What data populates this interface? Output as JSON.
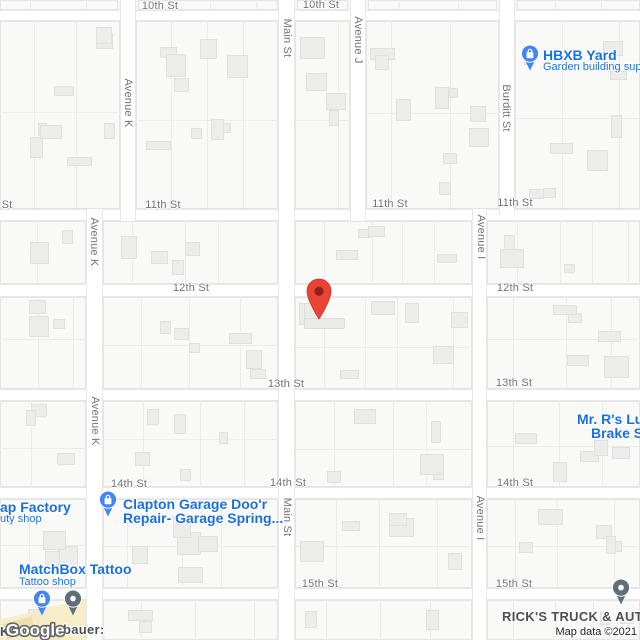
{
  "map_meta": {
    "logo": "Google",
    "attribution": "Map data ©2021"
  },
  "colors": {
    "poi_blue_text": "#1a6fdf",
    "poi_pin_blue": "#4285f4",
    "poi_pin_gray": "#5d7078",
    "poi_dark_text": "#4b4f54",
    "street_label": "#6f747a",
    "marker_red": "#EA4335",
    "marker_inner": "#8A231A",
    "road_fill": "#ffffff",
    "land": "#f6f6f4"
  },
  "street_labels": [
    {
      "t": "10th St",
      "x": 160,
      "y": 6
    },
    {
      "t": "10th St",
      "x": 321,
      "y": 5
    },
    {
      "t": "St",
      "x": 7,
      "y": 205
    },
    {
      "t": "11th St",
      "x": 163,
      "y": 205
    },
    {
      "t": "11th St",
      "x": 390,
      "y": 204
    },
    {
      "t": "11th St",
      "x": 515,
      "y": 203
    },
    {
      "t": "12th St",
      "x": 191,
      "y": 288
    },
    {
      "t": "12th St",
      "x": 515,
      "y": 288
    },
    {
      "t": "13th St",
      "x": 286,
      "y": 384
    },
    {
      "t": "13th St",
      "x": 514,
      "y": 383
    },
    {
      "t": "14th St",
      "x": 129,
      "y": 484
    },
    {
      "t": "14th St",
      "x": 288,
      "y": 483
    },
    {
      "t": "14th St",
      "x": 515,
      "y": 483
    },
    {
      "t": "15th St",
      "x": 320,
      "y": 584
    },
    {
      "t": "15th St",
      "x": 514,
      "y": 584
    },
    {
      "t": "Avenue K",
      "x": 128,
      "y": 103,
      "r": 1
    },
    {
      "t": "Avenue K",
      "x": 94,
      "y": 242,
      "r": 1
    },
    {
      "t": "Avenue K",
      "x": 95,
      "y": 421,
      "r": 1
    },
    {
      "t": "Main St",
      "x": 287,
      "y": 38,
      "r": 1
    },
    {
      "t": "Main St",
      "x": 287,
      "y": 517,
      "r": 1
    },
    {
      "t": "Avenue J",
      "x": 358,
      "y": 40,
      "r": 1
    },
    {
      "t": "Burditt St",
      "x": 506,
      "y": 108,
      "r": 1
    },
    {
      "t": "Avenue I",
      "x": 481,
      "y": 237,
      "r": 1
    },
    {
      "t": "Avenue I",
      "x": 480,
      "y": 518,
      "r": 1
    }
  ],
  "roads": {
    "h": [
      {
        "n": "10th-st",
        "y": 10,
        "h": 11,
        "x1": 0,
        "x2": 640
      },
      {
        "n": "11th-st",
        "y": 209,
        "h": 12,
        "x1": 0,
        "x2": 640
      },
      {
        "n": "12th-st",
        "y": 284,
        "h": 13,
        "x1": 0,
        "x2": 640
      },
      {
        "n": "13th-st",
        "y": 389,
        "h": 12,
        "x1": 0,
        "x2": 640
      },
      {
        "n": "14th-st",
        "y": 487,
        "h": 12,
        "x1": 0,
        "x2": 640
      },
      {
        "n": "15th-st",
        "y": 588,
        "h": 12,
        "x1": 0,
        "x2": 640
      }
    ],
    "v": [
      {
        "n": "avenue-k-upper",
        "x": 120,
        "w": 16,
        "y1": 0,
        "y2": 221
      },
      {
        "n": "avenue-k-lower",
        "x": 86,
        "w": 17,
        "y1": 209,
        "y2": 640
      },
      {
        "n": "main-st",
        "x": 278,
        "w": 17,
        "y1": 0,
        "y2": 640
      },
      {
        "n": "avenue-j",
        "x": 350,
        "w": 16,
        "y1": 0,
        "y2": 221
      },
      {
        "n": "burditt-st",
        "x": 499,
        "w": 16,
        "y1": 0,
        "y2": 215
      },
      {
        "n": "avenue-i",
        "x": 472,
        "w": 15,
        "y1": 209,
        "y2": 640
      }
    ]
  },
  "blocks": [
    [
      0,
      0,
      118,
      10
    ],
    [
      138,
      0,
      140,
      10
    ],
    [
      297,
      0,
      51,
      10
    ],
    [
      368,
      0,
      129,
      10
    ],
    [
      517,
      0,
      123,
      10
    ],
    [
      0,
      21,
      120,
      188
    ],
    [
      136,
      21,
      142,
      188
    ],
    [
      295,
      21,
      55,
      188
    ],
    [
      366,
      21,
      133,
      188
    ],
    [
      515,
      21,
      125,
      188
    ],
    [
      0,
      221,
      86,
      63
    ],
    [
      103,
      221,
      175,
      63
    ],
    [
      295,
      221,
      177,
      63
    ],
    [
      487,
      221,
      153,
      63
    ],
    [
      0,
      297,
      86,
      92
    ],
    [
      103,
      297,
      175,
      92
    ],
    [
      295,
      297,
      177,
      92
    ],
    [
      487,
      297,
      153,
      92
    ],
    [
      0,
      401,
      86,
      86
    ],
    [
      103,
      401,
      175,
      86
    ],
    [
      295,
      401,
      177,
      86
    ],
    [
      487,
      401,
      153,
      86
    ],
    [
      0,
      499,
      86,
      89
    ],
    [
      103,
      499,
      175,
      89
    ],
    [
      295,
      499,
      177,
      89
    ],
    [
      487,
      499,
      153,
      89
    ],
    [
      0,
      600,
      86,
      40
    ],
    [
      103,
      600,
      175,
      40
    ],
    [
      295,
      600,
      177,
      40
    ],
    [
      487,
      600,
      153,
      40
    ]
  ],
  "lots": [
    [
      304,
      303,
      16,
      26
    ],
    [
      304,
      318,
      41,
      11
    ]
  ],
  "marker": {
    "x": 306,
    "y": 278
  },
  "pois": [
    {
      "name": "hbxb-yard",
      "pin": {
        "x": 530,
        "y": 54,
        "style": "shop"
      },
      "title": {
        "t": "HBXB Yard",
        "x": 543,
        "y": 47
      },
      "subtitle": {
        "t": "Garden building sup",
        "x": 543,
        "y": 61
      }
    },
    {
      "name": "clapton-garage",
      "pin": {
        "x": 108,
        "y": 500,
        "style": "shop"
      },
      "title": {
        "t": "Clapton Garage Doo'r",
        "x": 123,
        "y": 496
      },
      "title2": {
        "t": "Repair- Garage Spring...",
        "x": 123,
        "y": 510
      }
    },
    {
      "name": "matchbox-tattoo",
      "title": {
        "t": "MatchBox Tattoo",
        "x": 19,
        "y": 561
      },
      "subtitle": {
        "t": "Tattoo shop",
        "x": 19,
        "y": 576
      }
    },
    {
      "name": "ap-factory",
      "title": {
        "t": "ap Factory",
        "x": 0,
        "y": 499
      },
      "subtitle": {
        "t": "uty shop",
        "x": 0,
        "y": 513
      }
    },
    {
      "name": "mr-rs-lube-brake",
      "title": {
        "t": "Mr. R's Lub",
        "x": 577,
        "y": 411
      },
      "title2": {
        "t": "Brake S",
        "x": 591,
        "y": 425
      }
    },
    {
      "name": "ricks-truck-auto",
      "pin": {
        "x": 621,
        "y": 588,
        "style": "generic"
      },
      "dark": {
        "t": "RICK'S TRUCK & AUTO",
        "x": 502,
        "y": 609
      }
    },
    {
      "name": "tattoo-shop-pin",
      "pin": {
        "x": 42,
        "y": 599,
        "style": "shop"
      }
    },
    {
      "name": "generic-poi-pin",
      "pin": {
        "x": 73,
        "y": 599,
        "style": "generic"
      }
    },
    {
      "name": "bauer-label",
      "dark": {
        "t": "bauer:",
        "x": 63,
        "y": 622
      }
    },
    {
      "name": "bauer-label-fragment",
      "dark": {
        "t": "K",
        "x": 0,
        "y": 624
      }
    }
  ]
}
